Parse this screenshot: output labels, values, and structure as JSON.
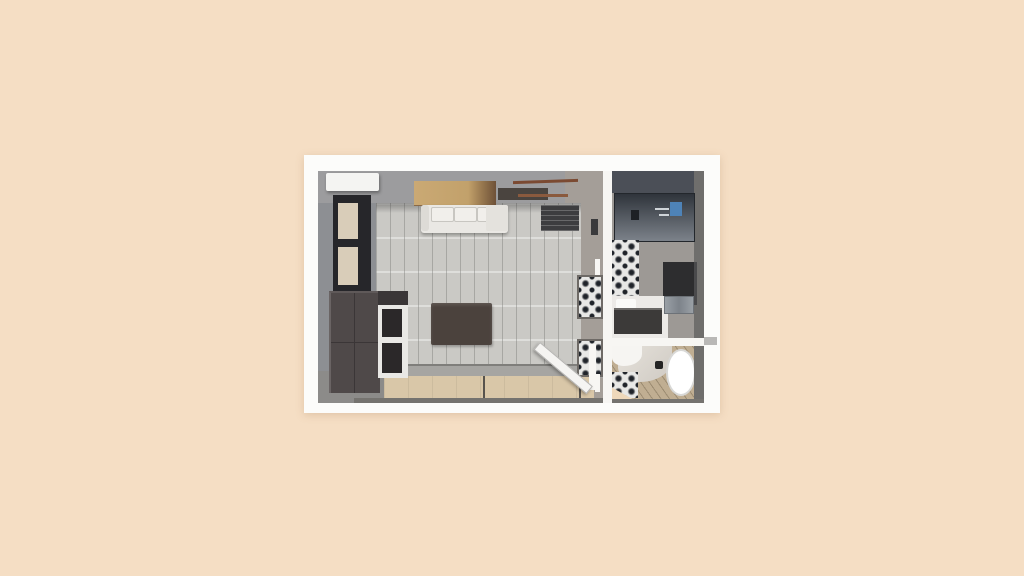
{
  "palette": {
    "bg": "#f5dec4",
    "card": "#fcfcfa",
    "wall-top": "#9c9c9e",
    "wall-left": "#8d8f93",
    "wall-warm": "#a49e98",
    "wall-dark": "#4b4f57",
    "wall-bath": "#9d9995",
    "wall-side": "#6f6e6c",
    "floor-living": "#cac9c5",
    "floor-bath": "#c0ae92",
    "floor-gray": "#8c8b89",
    "walkway": "#d9c7a8",
    "curb": "#a6a5a2",
    "lip": "#75736f",
    "white-wall": "#f7f6f3",
    "ac": "#f4f4f2",
    "window-frame": "#26262a",
    "window-pane": "#d9cdb9",
    "wardrobe": "#4f4949",
    "cabinet-frame": "#e9e8e5",
    "cabinet-dark": "#2b2829",
    "panel-tan": "#c2a16b",
    "panel-dark": "#6e5138",
    "shelf-brown": "#7b4a32",
    "shelf-dark": "#4a443f",
    "sofa": "#eae8e4",
    "rack": "#3d3d3f",
    "rug": "#4b423d",
    "tile-light": "#e8e8e6",
    "tile-dark": "#20242a",
    "mirror-top": "#2f343b",
    "mirror-bottom": "#7c828a",
    "photo-blue": "#4e83b8",
    "vanity": "#eceae7",
    "counter": "#3c3a39",
    "metal": "#9aa0a6",
    "tub": "#ffffff",
    "tub-edge": "#d8d8d6",
    "curve-gray": "#cfcac3",
    "door": "#f5f4f2",
    "tab": "#b9b8b6",
    "peach-floor": "#eed8ba"
  },
  "scene": {
    "view": "top-down-3d-floorplan",
    "rooms": [
      {
        "name": "living-room"
      },
      {
        "name": "bathroom"
      },
      {
        "name": "bathtub-room"
      }
    ],
    "objects": [
      "air-conditioner",
      "window",
      "wardrobe",
      "shelf-cabinet",
      "wood-sideboard",
      "sofa",
      "chaise",
      "wall-shelves",
      "clothes-rack",
      "wall-art",
      "rug",
      "open-door",
      "tile-niche",
      "shower-mirror",
      "vanity-sink",
      "wall-niche",
      "toilet",
      "bathtub",
      "patterned-tiles",
      "walkway-panels"
    ]
  }
}
